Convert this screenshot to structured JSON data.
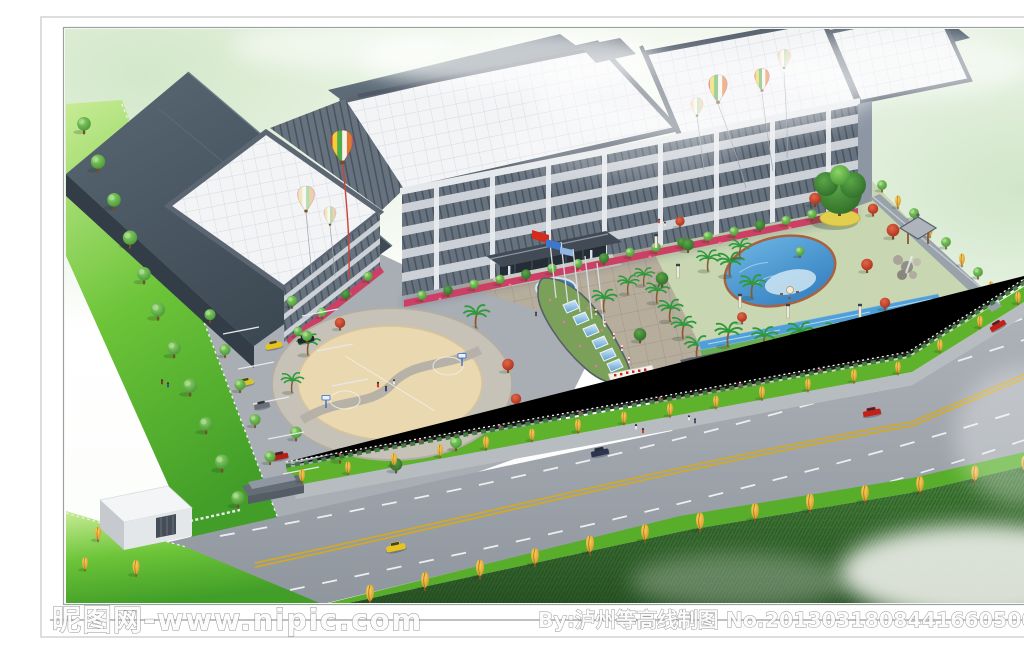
{
  "artwork": {
    "kind": "aerial architectural rendering",
    "description": "Bird's-eye perspective rendering of a factory and office campus: white-tiled workshop roofs, a five-storey office slab with banded windows, decorative hot-air balloons, an entrance plaza with flag poles and a stepped water cascade, a landscaped garden with swimming pool and pavilion, a circular basketball court plaza, a parking lot, a white gatehouse, and a wide tree-lined road with cars in front; soft green sky wash and dark grass foreground.",
    "elements": [
      "workshop roofs",
      "office building",
      "hot air balloons",
      "flag poles",
      "water cascade",
      "entrance gate",
      "gatehouse",
      "parking lot",
      "basketball court",
      "garden",
      "swimming pool",
      "pavilion",
      "rockery",
      "boundary wall",
      "street trees",
      "road",
      "cars",
      "pedestrians",
      "lawn"
    ]
  },
  "watermark": {
    "site": "昵图网-www.nipic.com",
    "credit": "By:泸州等高线制图  No.20130318084416605000"
  },
  "palette": {
    "sky_green": "#d7e9cf",
    "roof_tile_white": "#f3f4f6",
    "roof_slate_dark": "#46525e",
    "facade_window": "#67727f",
    "facade_band": "#ccd1d7",
    "lawn_bright": "#58b42c",
    "grass_dark": "#2c5a28",
    "road_asphalt": "#9aa0a7",
    "lane_yellow": "#d4aa1e",
    "pool_blue": "#4f9fd8",
    "flower_red": "#cc4066",
    "balloon_red": "#e03830",
    "gold_tree": "#e8b93c"
  }
}
